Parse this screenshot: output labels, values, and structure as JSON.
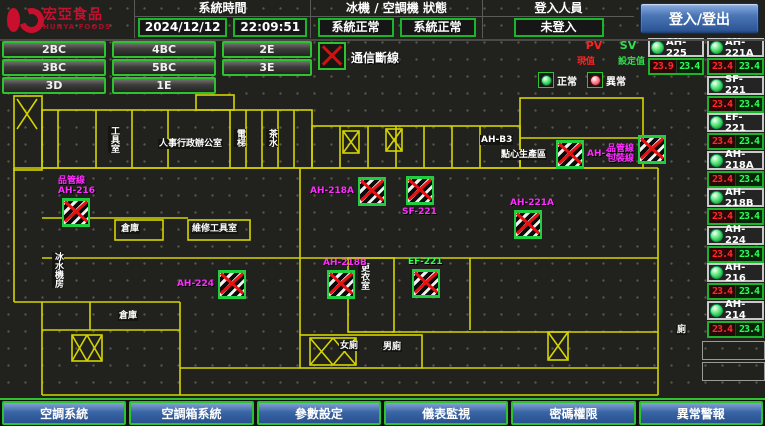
{
  "header": {
    "logo": {
      "brand": "宏亞食品",
      "brand_en": "HUNYA FOODS"
    },
    "system_time": {
      "label": "系統時間",
      "date": "2024/12/12",
      "time": "22:09:51"
    },
    "machine_status": {
      "label": "冰機 / 空調機 狀態",
      "chiller": "系統正常",
      "ac": "系統正常"
    },
    "login": {
      "label": "登入人員",
      "value": "未登入",
      "button": "登入/登出"
    }
  },
  "zones": {
    "buttons": [
      "2BC",
      "4BC",
      "2E",
      "3BC",
      "5BC",
      "3E",
      "3D",
      "1E"
    ]
  },
  "legend": {
    "comm_offline": "通信斷線",
    "pv": "PV",
    "sv": "SV",
    "pv_label": "現值",
    "sv_label": "設定值",
    "normal": "正常",
    "abnormal": "異常"
  },
  "units": [
    {
      "name": "AH-225",
      "pv": "23.9",
      "sv": "23.4"
    },
    {
      "name": "AH-221A",
      "pv": "23.4",
      "sv": "23.4"
    },
    {
      "name": "SF-221",
      "pv": "23.4",
      "sv": "23.4"
    },
    {
      "name": "EF-221",
      "pv": "23.4",
      "sv": "23.4"
    },
    {
      "name": "AH-218A",
      "pv": "23.4",
      "sv": "23.4"
    },
    {
      "name": "AH-218B",
      "pv": "23.4",
      "sv": "23.4"
    },
    {
      "name": "AH-224",
      "pv": "23.4",
      "sv": "23.4"
    },
    {
      "name": "AH-216",
      "pv": "23.4",
      "sv": "23.4"
    },
    {
      "name": "AH-214",
      "pv": "23.4",
      "sv": "23.4"
    }
  ],
  "floor_plan": {
    "markers": [
      {
        "x": 62,
        "y": 198,
        "lines": [
          "品管線",
          "AH-216"
        ],
        "color": "#ff2bff",
        "pos": "above"
      },
      {
        "x": 358,
        "y": 177,
        "lines": [
          "AH-218A"
        ],
        "color": "#ff2bff",
        "pos": "left"
      },
      {
        "x": 406,
        "y": 176,
        "lines": [
          "SF-221"
        ],
        "color": "#ff2bff",
        "pos": "below"
      },
      {
        "x": 514,
        "y": 210,
        "lines": [
          "AH-221A"
        ],
        "color": "#ff2bff",
        "pos": "above"
      },
      {
        "x": 556,
        "y": 140,
        "lines": [
          "AH-214"
        ],
        "color": "#ff2bff",
        "pos": "right"
      },
      {
        "x": 638,
        "y": 135,
        "lines": [
          "品管線",
          "包裝線"
        ],
        "color": "#ff2bff",
        "pos": "left"
      },
      {
        "x": 218,
        "y": 270,
        "lines": [
          "AH-224"
        ],
        "color": "#ff2bff",
        "pos": "left"
      },
      {
        "x": 327,
        "y": 270,
        "lines": [
          "AH-218B"
        ],
        "color": "#ff2bff",
        "pos": "above"
      },
      {
        "x": 412,
        "y": 269,
        "lines": [
          "EF-221"
        ],
        "color": "#2bff4f",
        "pos": "above"
      }
    ],
    "rooms": [
      {
        "text": "工具室",
        "x": 108,
        "y": 126,
        "v": true
      },
      {
        "text": "人事行政辦公室",
        "x": 158,
        "y": 139,
        "v": false
      },
      {
        "text": "電梯",
        "x": 234,
        "y": 129,
        "v": true
      },
      {
        "text": "茶水",
        "x": 266,
        "y": 129,
        "v": true
      },
      {
        "text": "AH-B3",
        "x": 480,
        "y": 135,
        "v": false
      },
      {
        "text": "點心生產區",
        "x": 500,
        "y": 150,
        "v": false
      },
      {
        "text": "倉庫",
        "x": 120,
        "y": 224,
        "v": false
      },
      {
        "text": "維修工具室",
        "x": 191,
        "y": 224,
        "v": false
      },
      {
        "text": "冰水機房",
        "x": 52,
        "y": 252,
        "v": true
      },
      {
        "text": "更衣室",
        "x": 358,
        "y": 263,
        "v": true
      },
      {
        "text": "倉庫",
        "x": 118,
        "y": 311,
        "v": false
      },
      {
        "text": "女廁",
        "x": 339,
        "y": 341,
        "v": false
      },
      {
        "text": "男廁",
        "x": 382,
        "y": 342,
        "v": false
      },
      {
        "text": "廁",
        "x": 676,
        "y": 325,
        "v": false
      }
    ]
  },
  "nav": {
    "buttons": [
      "空調系統",
      "空調箱系統",
      "參數設定",
      "儀表監視",
      "密碼權限",
      "異常警報"
    ]
  },
  "colors": {
    "accent_green": "#2ec22e",
    "alarm_red": "#e81010",
    "label_magenta": "#ff2bff",
    "nav_blue": "#3a66a6",
    "brand_red": "#c8102e",
    "wall_yellow": "#d4d400"
  }
}
